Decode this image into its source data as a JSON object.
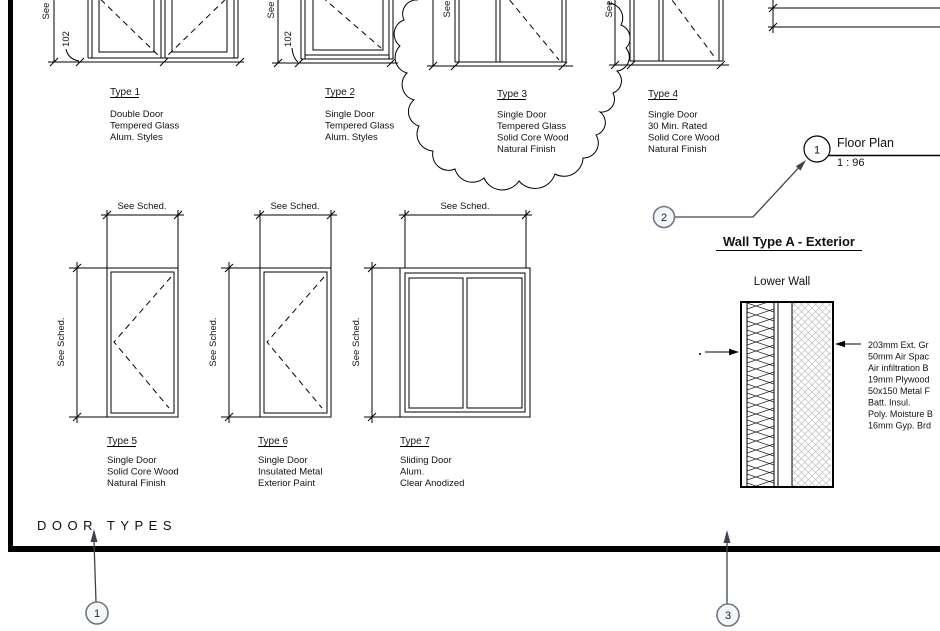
{
  "colors": {
    "line": "#000000",
    "text": "#121216",
    "balloon_stroke": "#6e7681",
    "balloon_fill": "#f6f7f9",
    "arrow": "#3d4450",
    "hatch": "#bfbfbf"
  },
  "titles": {
    "sheet_label": "DOOR TYPES"
  },
  "dims": {
    "see": "See",
    "see_sched": "See Sched.",
    "frame_102": "102"
  },
  "door_types": [
    {
      "label": "Type 1",
      "desc": [
        "Double Door",
        "Tempered Glass",
        "Alum. Styles"
      ]
    },
    {
      "label": "Type 2",
      "desc": [
        "Single Door",
        "Tempered Glass",
        "Alum. Styles"
      ]
    },
    {
      "label": "Type 3",
      "desc": [
        "Single Door",
        "Tempered Glass",
        "Solid Core Wood",
        "Natural Finish"
      ]
    },
    {
      "label": "Type 4",
      "desc": [
        "Single Door",
        "30 Min. Rated",
        "Solid Core Wood",
        "Natural Finish"
      ]
    },
    {
      "label": "Type 5",
      "desc": [
        "Single Door",
        "Solid Core Wood",
        "Natural Finish"
      ]
    },
    {
      "label": "Type 6",
      "desc": [
        "Single Door",
        "Insulated Metal",
        "Exterior Paint"
      ]
    },
    {
      "label": "Type 7",
      "desc": [
        "Sliding Door",
        "Alum.",
        "Clear Anodized"
      ]
    }
  ],
  "floor_plan": {
    "number": "1",
    "title": "Floor Plan",
    "scale": "1 : 96"
  },
  "wall_detail": {
    "heading": "Wall Type A - Exterior",
    "subheading": "Lower Wall",
    "notes": [
      "203mm Ext. Gr",
      "50mm Air Spac",
      "Air infiltration B",
      "19mm Plywood",
      "50x150 Metal F",
      "Batt. Insul.",
      "Poly. Moisture B",
      "16mm Gyp. Brd"
    ]
  },
  "balloons": {
    "b1": "1",
    "b2": "2",
    "b3": "3"
  }
}
